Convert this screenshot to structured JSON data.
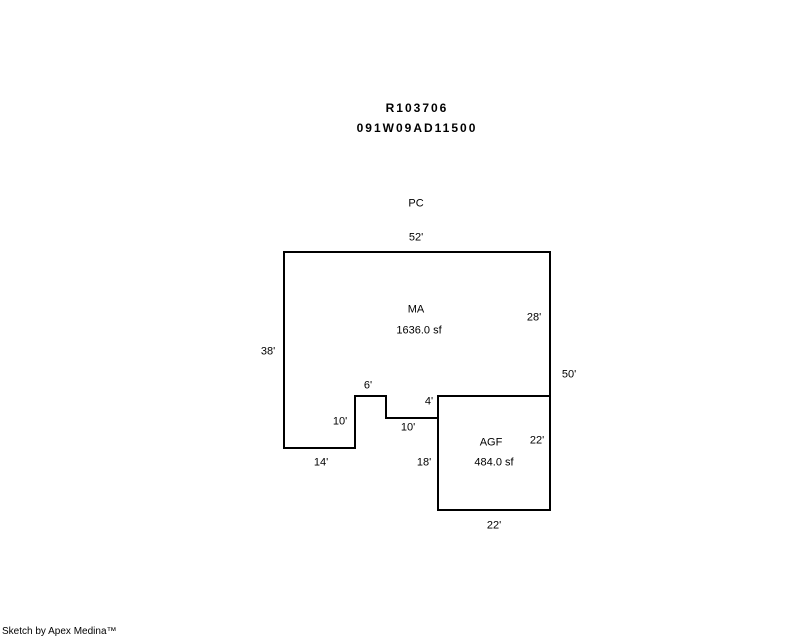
{
  "colors": {
    "background": "#ffffff",
    "ink": "#000000"
  },
  "header": {
    "record_number": "R103706",
    "parcel_number": "091W09AD11500"
  },
  "sketch": {
    "exterior_area_label": "PC",
    "areas": {
      "ma": {
        "code": "MA",
        "area": "1636.0 sf"
      },
      "agf": {
        "code": "AGF",
        "area": "484.0 sf"
      }
    },
    "dims": {
      "top": "52'",
      "left": "38'",
      "right_upper": "28'",
      "right_total": "50'",
      "notch_top": "6'",
      "step_side": "4'",
      "left_lobe_side": "10'",
      "notch_bottom": "10'",
      "bottom_left": "14'",
      "agf_left": "18'",
      "agf_right": "22'",
      "agf_bottom": "22'"
    }
  },
  "footer": {
    "credit": "Sketch by Apex Medina™"
  }
}
